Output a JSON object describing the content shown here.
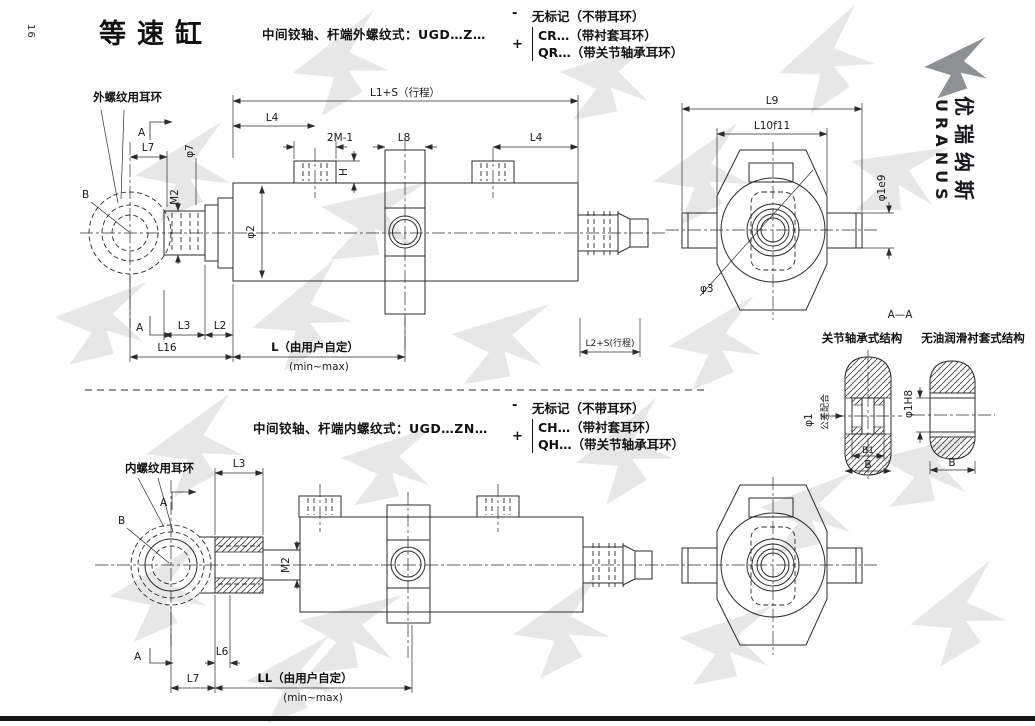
{
  "page": {
    "number": "16",
    "title": "等速缸",
    "brand_cn": "优瑞纳斯",
    "brand_en": "URANUS"
  },
  "variant_top": {
    "formula": "中间铰轴、杆端外螺纹式：UGD…Z…",
    "minus_sign": "-",
    "plus_sign": "+",
    "option_none": "无标记（不带耳环）",
    "option_bush": "CR…（带衬套耳环）",
    "option_bearing": "QR…（带关节轴承耳环）"
  },
  "variant_bottom": {
    "formula": "中间铰轴、杆端内螺纹式：UGD…ZN…",
    "minus_sign": "-",
    "plus_sign": "+",
    "option_none": "无标记（不带耳环）",
    "option_bush": "CH…（带衬套耳环）",
    "option_bearing": "QH…（带关节轴承耳环）"
  },
  "top_view": {
    "eyelet_label": "外螺纹用耳环",
    "section_mark": "A",
    "point_b": "B",
    "dim_l1s": "L1+S（行程）",
    "dim_l4_left": "L4",
    "dim_2m1": "2M-1",
    "dim_l8": "L8",
    "dim_l4_right": "L4",
    "dim_h": "H",
    "dim_l7": "L7",
    "dim_d7": "φ7",
    "dim_m2": "M2",
    "dim_d2": "φ2",
    "dim_l3": "L3",
    "dim_l2": "L2",
    "dim_l16": "L16",
    "dim_l_user": "L（由用户自定）",
    "dim_minmax": "(min~max)",
    "dim_l2s": "L2+S(行程)"
  },
  "end_view_top": {
    "dim_l9": "L9",
    "dim_l10": "L10f11",
    "dim_d1e9": "φ1e9",
    "dim_d3": "φ3"
  },
  "section_aa": {
    "title": "A—A",
    "left_caption": "关节轴承式结构",
    "right_caption": "无油润滑衬套式结构",
    "dim_d1": "φ1",
    "fit_note": "公差配合",
    "dim_b1": "B1",
    "dim_b_left": "B",
    "dim_d1h8": "φ1H8",
    "dim_b_right": "B"
  },
  "bottom_view": {
    "eyelet_label": "内螺纹用耳环",
    "section_mark": "A",
    "point_b": "B",
    "dim_l3": "L3",
    "dim_m2": "M2",
    "dim_l6": "L6",
    "dim_l7": "L7",
    "dim_ll_user": "LL（由用户自定）",
    "dim_minmax": "(min~max)"
  }
}
